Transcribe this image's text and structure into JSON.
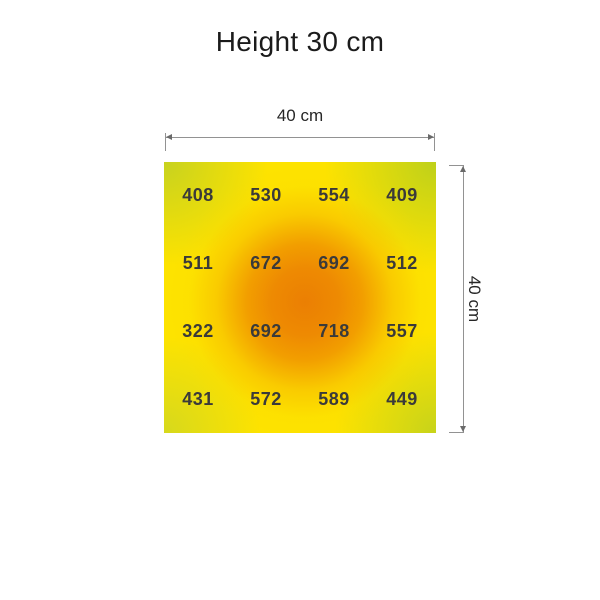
{
  "title": "Height 30 cm",
  "dimensions": {
    "width_label": "40 cm",
    "height_label": "40 cm"
  },
  "chart_data": {
    "type": "heatmap",
    "title": "Height 30 cm",
    "area_width_label": "40 cm",
    "area_height_label": "40 cm",
    "grid_rows": 4,
    "grid_cols": 4,
    "values": [
      [
        408,
        530,
        554,
        409
      ],
      [
        511,
        672,
        692,
        512
      ],
      [
        322,
        692,
        718,
        557
      ],
      [
        431,
        572,
        589,
        449
      ]
    ],
    "value_min": 322,
    "value_max": 718,
    "layout": {
      "legend": "none",
      "grid_lines": "off",
      "value_labels": "centered in each cell"
    },
    "colors": {
      "base_yellow": "#fde300",
      "corner_green": "#a3c734",
      "center_orange": "#ee8a02",
      "value_text": "#3a3a3a",
      "dimension_line": "#929292",
      "text": "#1b1b1b"
    }
  }
}
